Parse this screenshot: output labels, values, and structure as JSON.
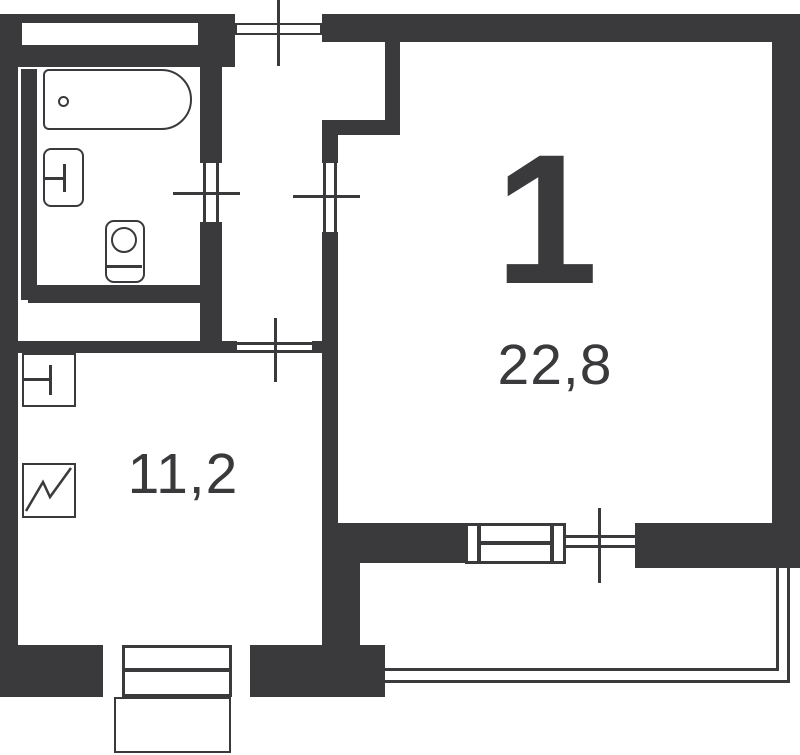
{
  "floor_plan": {
    "type_label": "1",
    "rooms": {
      "living_room": {
        "name": "living-room",
        "area": "22,8"
      },
      "kitchen": {
        "name": "kitchen",
        "area": "11,2"
      },
      "bathroom": {
        "name": "bathroom",
        "area": ""
      }
    },
    "colors": {
      "walls": "#3a3a3c",
      "background": "#ffffff"
    },
    "fixtures": [
      "bathtub",
      "washbasin",
      "toilet",
      "kitchen-sink",
      "stove"
    ],
    "features": [
      "entrance-door",
      "bathroom-door",
      "living-room-door",
      "kitchen-door",
      "balcony-door",
      "living-room-window",
      "kitchen-window",
      "balcony-parapet",
      "porch"
    ]
  }
}
